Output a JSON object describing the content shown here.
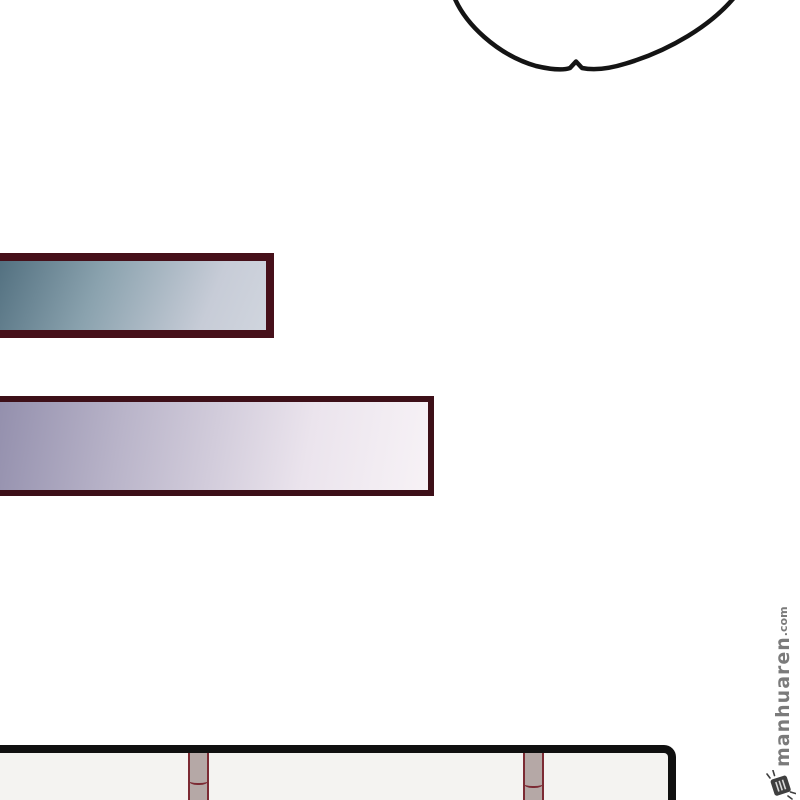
{
  "watermark": {
    "site_name": "manhuaren",
    "domain_suffix": ".com",
    "logo": "stamp-seal-logo-icon"
  },
  "scene": {
    "elements": [
      "speech-bubble-bottom-curve",
      "gradient-banner-top",
      "gradient-banner-bottom",
      "comic-panel-frame",
      "table-leg-left",
      "table-leg-right"
    ]
  },
  "colors": {
    "page_bg": "#ffffff",
    "bubble_outline": "#141414",
    "banner1_border": "#46101a",
    "banner1_g0": "#4f6d7d",
    "banner1_g1": "#8aa2ae",
    "banner1_g2": "#c7ccd7",
    "banner1_g3": "#d0d5de",
    "banner2_border": "#3d0f18",
    "banner2_g0": "#918dab",
    "banner2_g1": "#b9b4c9",
    "banner2_g2": "#ebe4ed",
    "banner2_g3": "#f7f2f6",
    "panel_border": "#101010",
    "panel_fill": "#f4f3f1",
    "post_fill": "#b5a8a6",
    "post_border": "#7c2a33",
    "watermark_text": "#7b7b7b",
    "watermark_logo": "#3f3f3f"
  }
}
